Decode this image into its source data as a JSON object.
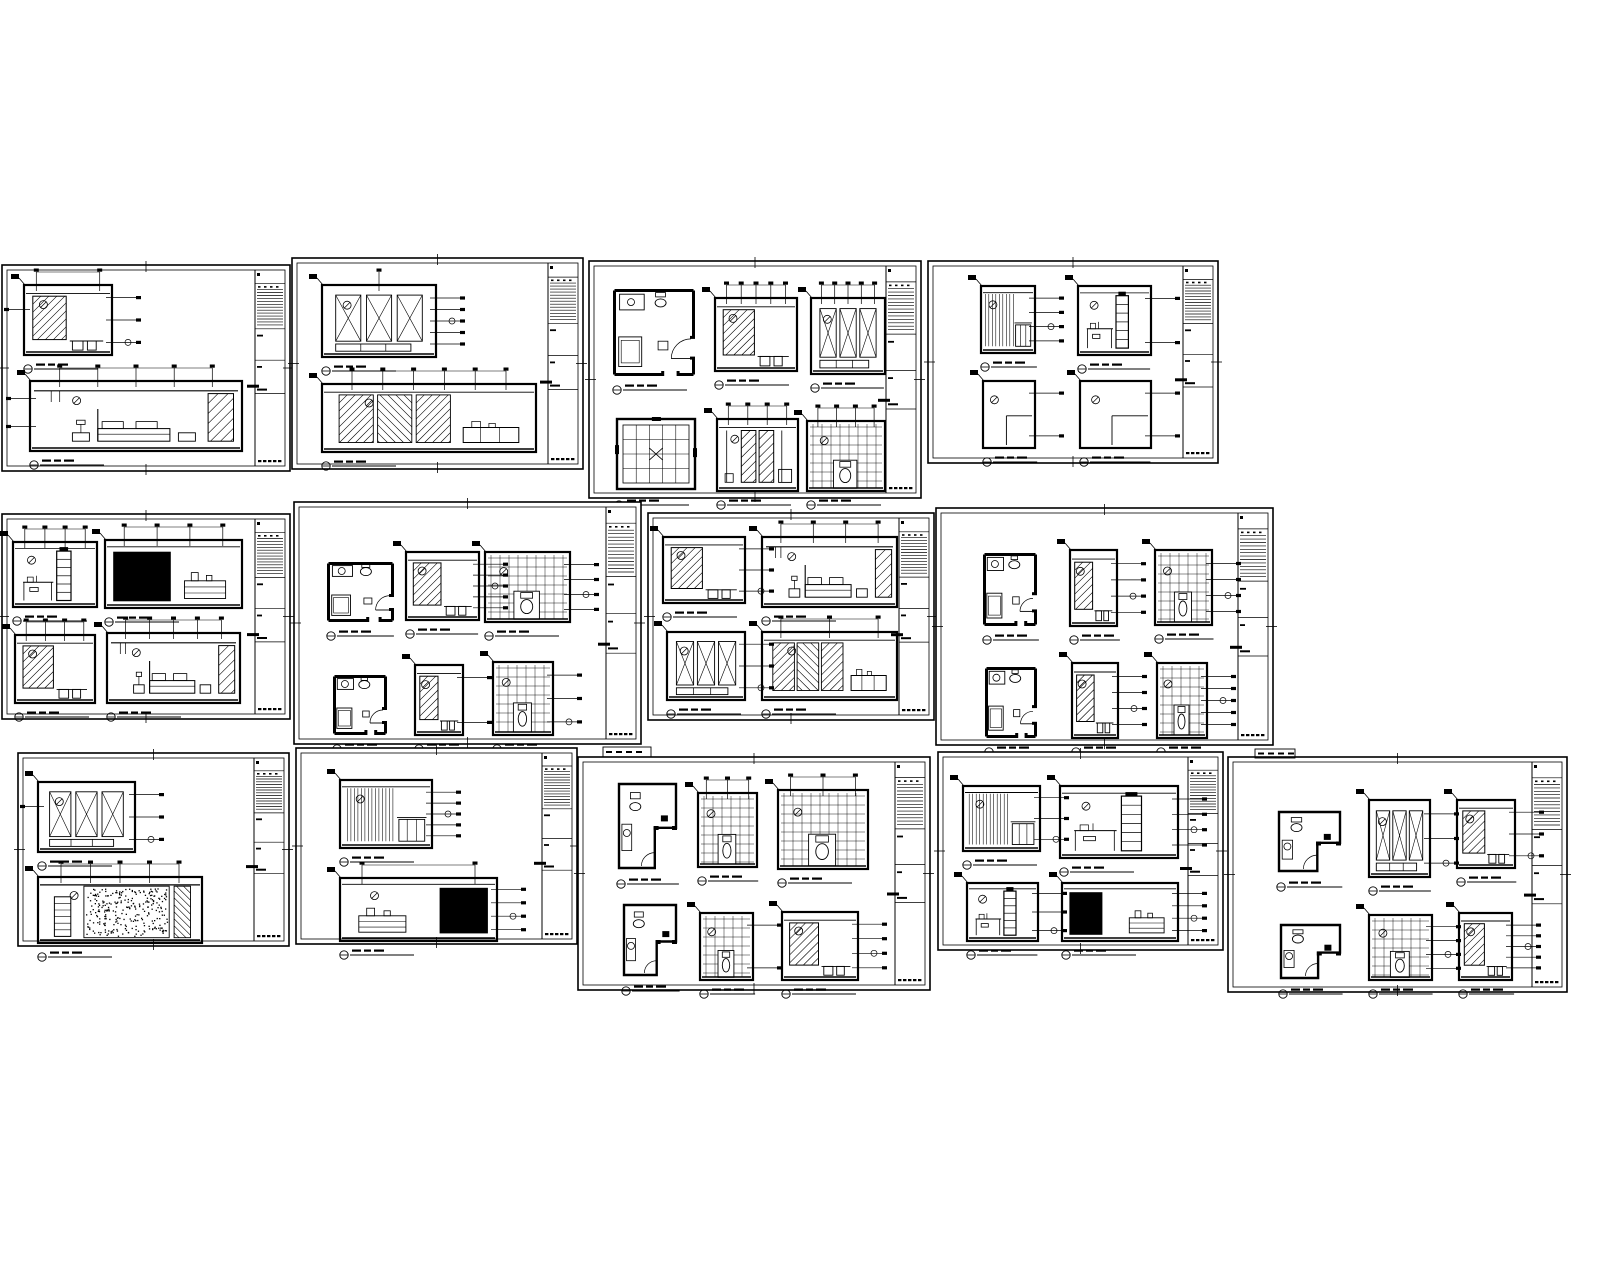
{
  "canvas": {
    "width": 1600,
    "height": 1280,
    "background": "#ffffff",
    "ink": "#000000"
  },
  "stamps": [
    {
      "x": 603,
      "y": 747,
      "w": 48,
      "h": 10
    },
    {
      "x": 1255,
      "y": 749,
      "w": 40,
      "h": 9
    }
  ],
  "sheets": [
    {
      "id": "sheet-01",
      "frame": {
        "x": 2,
        "y": 265,
        "w": 288,
        "h": 206
      },
      "title_block": {
        "side": "right",
        "width": 30
      },
      "figures": [
        {
          "kind": "elev-diag",
          "x": 22,
          "y": 20,
          "w": 88,
          "h": 70,
          "leaders": {
            "r": 3,
            "t": 2,
            "l": 1
          }
        },
        {
          "kind": "elev-bed",
          "x": 28,
          "y": 116,
          "w": 212,
          "h": 70,
          "leaders": {
            "t": 5,
            "l": 2
          }
        }
      ]
    },
    {
      "id": "sheet-02",
      "frame": {
        "x": 292,
        "y": 258,
        "w": 291,
        "h": 211
      },
      "title_block": {
        "side": "right",
        "width": 30
      },
      "figures": [
        {
          "kind": "elev-x",
          "x": 30,
          "y": 27,
          "w": 114,
          "h": 72,
          "leaders": {
            "r": 5,
            "t": 1
          }
        },
        {
          "kind": "elev-ward",
          "x": 30,
          "y": 126,
          "w": 214,
          "h": 68,
          "leaders": {
            "t": 6
          }
        }
      ]
    },
    {
      "id": "sheet-03",
      "frame": {
        "x": 589,
        "y": 261,
        "w": 332,
        "h": 237
      },
      "title_block": {
        "side": "right",
        "width": 30
      },
      "figures": [
        {
          "kind": "plan",
          "x": 24,
          "y": 28,
          "w": 82,
          "h": 87
        },
        {
          "kind": "elev-diag",
          "x": 126,
          "y": 37,
          "w": 82,
          "h": 73,
          "leaders": {
            "t": 5
          }
        },
        {
          "kind": "elev-x",
          "x": 222,
          "y": 37,
          "w": 74,
          "h": 76,
          "leaders": {
            "t": 5
          }
        },
        {
          "kind": "plan-grid",
          "x": 26,
          "y": 156,
          "w": 82,
          "h": 74
        },
        {
          "kind": "elev-door",
          "x": 128,
          "y": 158,
          "w": 81,
          "h": 72,
          "leaders": {
            "t": 4
          }
        },
        {
          "kind": "elev-grid",
          "x": 218,
          "y": 160,
          "w": 78,
          "h": 70,
          "leaders": {
            "t": 4
          }
        }
      ]
    },
    {
      "id": "sheet-04",
      "frame": {
        "x": 928,
        "y": 261,
        "w": 290,
        "h": 202
      },
      "title_block": {
        "side": "right",
        "width": 30
      },
      "figures": [
        {
          "kind": "elev-slats",
          "x": 53,
          "y": 25,
          "w": 54,
          "h": 67,
          "leaders": {
            "r": 4
          }
        },
        {
          "kind": "elev-shelf",
          "x": 150,
          "y": 25,
          "w": 73,
          "h": 69,
          "leaders": {
            "r": 2
          }
        },
        {
          "kind": "elev-empty",
          "x": 55,
          "y": 120,
          "w": 52,
          "h": 67,
          "leaders": {
            "r": 2
          }
        },
        {
          "kind": "elev-empty",
          "x": 152,
          "y": 120,
          "w": 71,
          "h": 67,
          "leaders": {
            "r": 2
          }
        }
      ]
    },
    {
      "id": "sheet-05",
      "frame": {
        "x": 2,
        "y": 514,
        "w": 288,
        "h": 205
      },
      "title_block": {
        "side": "right",
        "width": 30
      },
      "figures": [
        {
          "kind": "elev-shelf",
          "x": 11,
          "y": 28,
          "w": 84,
          "h": 65,
          "leaders": {
            "t": 4
          }
        },
        {
          "kind": "elev-dark",
          "x": 103,
          "y": 26,
          "w": 137,
          "h": 68,
          "leaders": {
            "t": 4
          },
          "dark": [
            0.04,
            0.14,
            0.44,
            0.8
          ]
        },
        {
          "kind": "elev-diag",
          "x": 13,
          "y": 121,
          "w": 80,
          "h": 68,
          "leaders": {
            "t": 4
          }
        },
        {
          "kind": "elev-bed",
          "x": 105,
          "y": 119,
          "w": 133,
          "h": 70,
          "leaders": {
            "t": 5
          }
        }
      ]
    },
    {
      "id": "sheet-06",
      "frame": {
        "x": 294,
        "y": 502,
        "w": 347,
        "h": 242
      },
      "title_block": {
        "side": "right",
        "width": 30
      },
      "figures": [
        {
          "kind": "plan",
          "x": 33,
          "y": 60,
          "w": 67,
          "h": 60
        },
        {
          "kind": "elev-diag",
          "x": 112,
          "y": 50,
          "w": 73,
          "h": 68,
          "leaders": {
            "r": 5
          }
        },
        {
          "kind": "elev-grid",
          "x": 191,
          "y": 50,
          "w": 85,
          "h": 70,
          "leaders": {
            "r": 4
          }
        },
        {
          "kind": "plan",
          "x": 39,
          "y": 173,
          "w": 54,
          "h": 60
        },
        {
          "kind": "elev-diag",
          "x": 121,
          "y": 163,
          "w": 48,
          "h": 70,
          "leaders": {
            "r": 2
          }
        },
        {
          "kind": "elev-grid",
          "x": 199,
          "y": 160,
          "w": 60,
          "h": 73,
          "leaders": {
            "r": 3
          }
        }
      ]
    },
    {
      "id": "sheet-07",
      "frame": {
        "x": 648,
        "y": 513,
        "w": 286,
        "h": 207
      },
      "title_block": {
        "side": "right",
        "width": 30
      },
      "figures": [
        {
          "kind": "elev-diag",
          "x": 15,
          "y": 24,
          "w": 82,
          "h": 66,
          "leaders": {
            "r": 3
          }
        },
        {
          "kind": "elev-bed",
          "x": 114,
          "y": 24,
          "w": 135,
          "h": 70,
          "leaders": {
            "t": 4
          }
        },
        {
          "kind": "elev-x",
          "x": 19,
          "y": 119,
          "w": 78,
          "h": 68,
          "leaders": {
            "r": 3
          }
        },
        {
          "kind": "elev-ward",
          "x": 114,
          "y": 119,
          "w": 135,
          "h": 68,
          "leaders": {
            "t": 3
          }
        }
      ]
    },
    {
      "id": "sheet-08",
      "frame": {
        "x": 936,
        "y": 508,
        "w": 337,
        "h": 237
      },
      "title_block": {
        "side": "right",
        "width": 30
      },
      "figures": [
        {
          "kind": "plan",
          "x": 47,
          "y": 45,
          "w": 54,
          "h": 73
        },
        {
          "kind": "elev-diag",
          "x": 134,
          "y": 42,
          "w": 47,
          "h": 76,
          "leaders": {
            "r": 4
          }
        },
        {
          "kind": "elev-grid",
          "x": 219,
          "y": 42,
          "w": 57,
          "h": 75,
          "leaders": {
            "r": 4
          }
        },
        {
          "kind": "plan",
          "x": 49,
          "y": 159,
          "w": 52,
          "h": 71
        },
        {
          "kind": "elev-diag",
          "x": 136,
          "y": 155,
          "w": 46,
          "h": 75,
          "leaders": {
            "r": 4
          }
        },
        {
          "kind": "elev-grid",
          "x": 221,
          "y": 155,
          "w": 50,
          "h": 75,
          "leaders": {
            "r": 5
          }
        }
      ]
    },
    {
      "id": "sheet-09",
      "frame": {
        "x": 18,
        "y": 753,
        "w": 271,
        "h": 193
      },
      "title_block": {
        "side": "right",
        "width": 30
      },
      "figures": [
        {
          "kind": "elev-x",
          "x": 20,
          "y": 29,
          "w": 97,
          "h": 70,
          "leaders": {
            "r": 3,
            "l": 1
          }
        },
        {
          "kind": "elev-stipple",
          "x": 20,
          "y": 124,
          "w": 164,
          "h": 66,
          "leaders": {
            "t": 5
          }
        }
      ]
    },
    {
      "id": "sheet-10",
      "frame": {
        "x": 296,
        "y": 748,
        "w": 281,
        "h": 196
      },
      "title_block": {
        "side": "right",
        "width": 30
      },
      "figures": [
        {
          "kind": "elev-slats",
          "x": 44,
          "y": 32,
          "w": 92,
          "h": 68,
          "leaders": {
            "r": 5
          }
        },
        {
          "kind": "elev-dark",
          "x": 44,
          "y": 130,
          "w": 157,
          "h": 63,
          "leaders": {
            "t": 2,
            "r": 4
          },
          "dark": [
            0.64,
            0.12,
            0.32,
            0.8
          ]
        }
      ]
    },
    {
      "id": "sheet-11",
      "frame": {
        "x": 578,
        "y": 757,
        "w": 352,
        "h": 233
      },
      "title_block": {
        "side": "right",
        "width": 30
      },
      "figures": [
        {
          "kind": "plan-l",
          "x": 39,
          "y": 25,
          "w": 61,
          "h": 88
        },
        {
          "kind": "elev-grid",
          "x": 120,
          "y": 36,
          "w": 59,
          "h": 74,
          "leaders": {
            "t": 3
          }
        },
        {
          "kind": "elev-grid",
          "x": 200,
          "y": 33,
          "w": 90,
          "h": 79,
          "leaders": {
            "t": 3
          }
        },
        {
          "kind": "plan-l",
          "x": 44,
          "y": 146,
          "w": 56,
          "h": 74
        },
        {
          "kind": "elev-grid",
          "x": 122,
          "y": 156,
          "w": 53,
          "h": 67,
          "leaders": {
            "r": 2
          }
        },
        {
          "kind": "elev-diag",
          "x": 204,
          "y": 155,
          "w": 76,
          "h": 68,
          "leaders": {
            "r": 4
          }
        }
      ]
    },
    {
      "id": "sheet-12",
      "frame": {
        "x": 938,
        "y": 752,
        "w": 285,
        "h": 198
      },
      "title_block": {
        "side": "right",
        "width": 30
      },
      "figures": [
        {
          "kind": "elev-slats",
          "x": 25,
          "y": 34,
          "w": 77,
          "h": 65,
          "leaders": {
            "r": 3
          }
        },
        {
          "kind": "elev-shelf",
          "x": 122,
          "y": 34,
          "w": 118,
          "h": 72,
          "leaders": {
            "r": 4
          }
        },
        {
          "kind": "elev-shelf",
          "x": 29,
          "y": 131,
          "w": 71,
          "h": 58,
          "leaders": {
            "r": 3
          }
        },
        {
          "kind": "elev-dark",
          "x": 124,
          "y": 131,
          "w": 116,
          "h": 58,
          "leaders": {
            "r": 4
          },
          "dark": [
            0.04,
            0.12,
            0.3,
            0.82
          ]
        }
      ]
    },
    {
      "id": "sheet-13",
      "frame": {
        "x": 1228,
        "y": 757,
        "w": 339,
        "h": 235
      },
      "title_block": {
        "side": "right",
        "width": 30
      },
      "figures": [
        {
          "kind": "plan-l",
          "x": 49,
          "y": 53,
          "w": 65,
          "h": 63
        },
        {
          "kind": "elev-x",
          "x": 141,
          "y": 43,
          "w": 61,
          "h": 77,
          "leaders": {
            "r": 3
          }
        },
        {
          "kind": "elev-diag",
          "x": 229,
          "y": 43,
          "w": 58,
          "h": 68,
          "leaders": {
            "r": 3
          }
        },
        {
          "kind": "plan-l",
          "x": 51,
          "y": 166,
          "w": 63,
          "h": 57
        },
        {
          "kind": "elev-grid",
          "x": 141,
          "y": 158,
          "w": 63,
          "h": 65,
          "leaders": {
            "r": 4
          }
        },
        {
          "kind": "elev-diag",
          "x": 231,
          "y": 156,
          "w": 53,
          "h": 67,
          "leaders": {
            "r": 5
          }
        }
      ]
    }
  ]
}
